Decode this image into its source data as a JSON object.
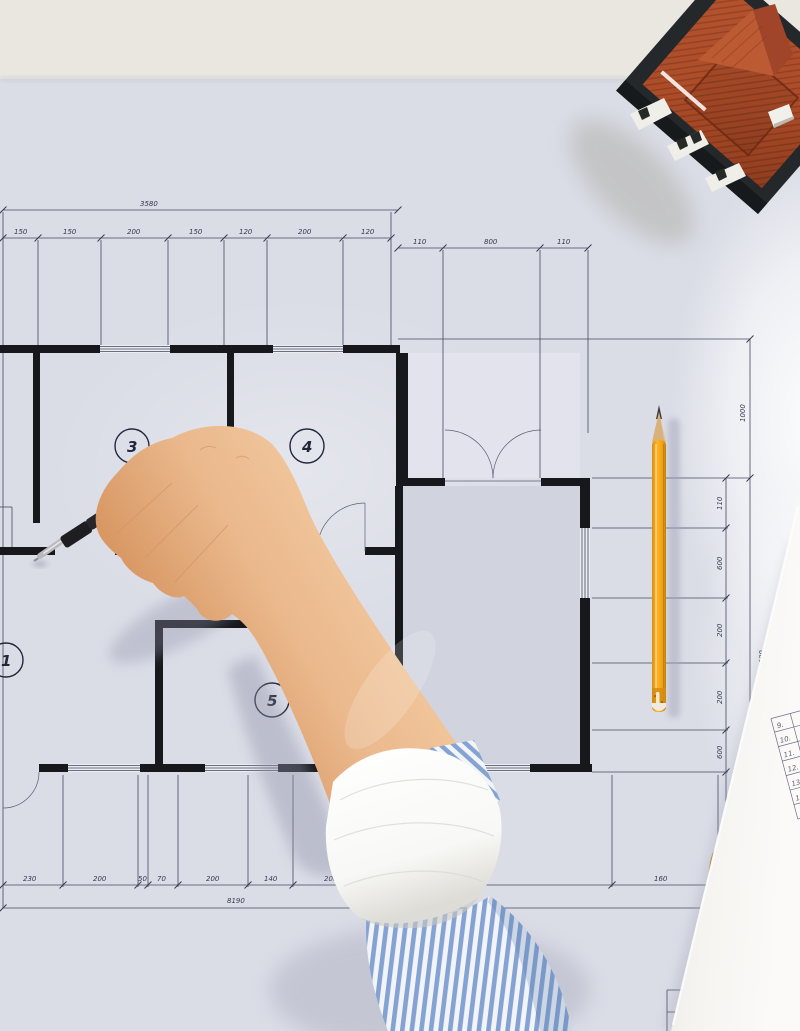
{
  "plan": {
    "room_numbers": [
      "3",
      "4",
      "1",
      "5"
    ],
    "dims": {
      "top_overall": "3580",
      "top_chain": [
        "150",
        "150",
        "200",
        "150",
        "120",
        "200",
        "120"
      ],
      "top_right_chain": [
        "110",
        "800",
        "110"
      ],
      "right_upper": "1000",
      "right_outer": "4300",
      "right_chain": [
        "110",
        "600",
        "200",
        "200",
        "600"
      ],
      "bottom_chain": [
        "230",
        "200",
        "50",
        "70",
        "200",
        "140",
        "200",
        "160"
      ],
      "bottom_overall": "8190"
    }
  },
  "note_paper": {
    "row_labels": [
      "9.",
      "10.",
      "11.",
      "12.",
      "13.",
      "14."
    ],
    "handwritten_label": "15"
  },
  "colors": {
    "desk": "#e9e7e0",
    "blueprint_paper": "#dadce6",
    "garage_fill": "#d1d3de",
    "wall": "#17181c",
    "pencil_orange": "#fbb528",
    "pencil_wood": "#e6c18f",
    "roof_terracotta": "#b4532e",
    "roof_dark": "#9a4223",
    "house_base": "#24282a",
    "chimney_white": "#f2f0ea",
    "skin_mid": "#eab88c",
    "sleeve_blue": "#84a3d3",
    "cuff_white": "#f8f8f6",
    "note_paper_white": "#f5f4f1",
    "clipboard_tan": "#c28e50"
  }
}
